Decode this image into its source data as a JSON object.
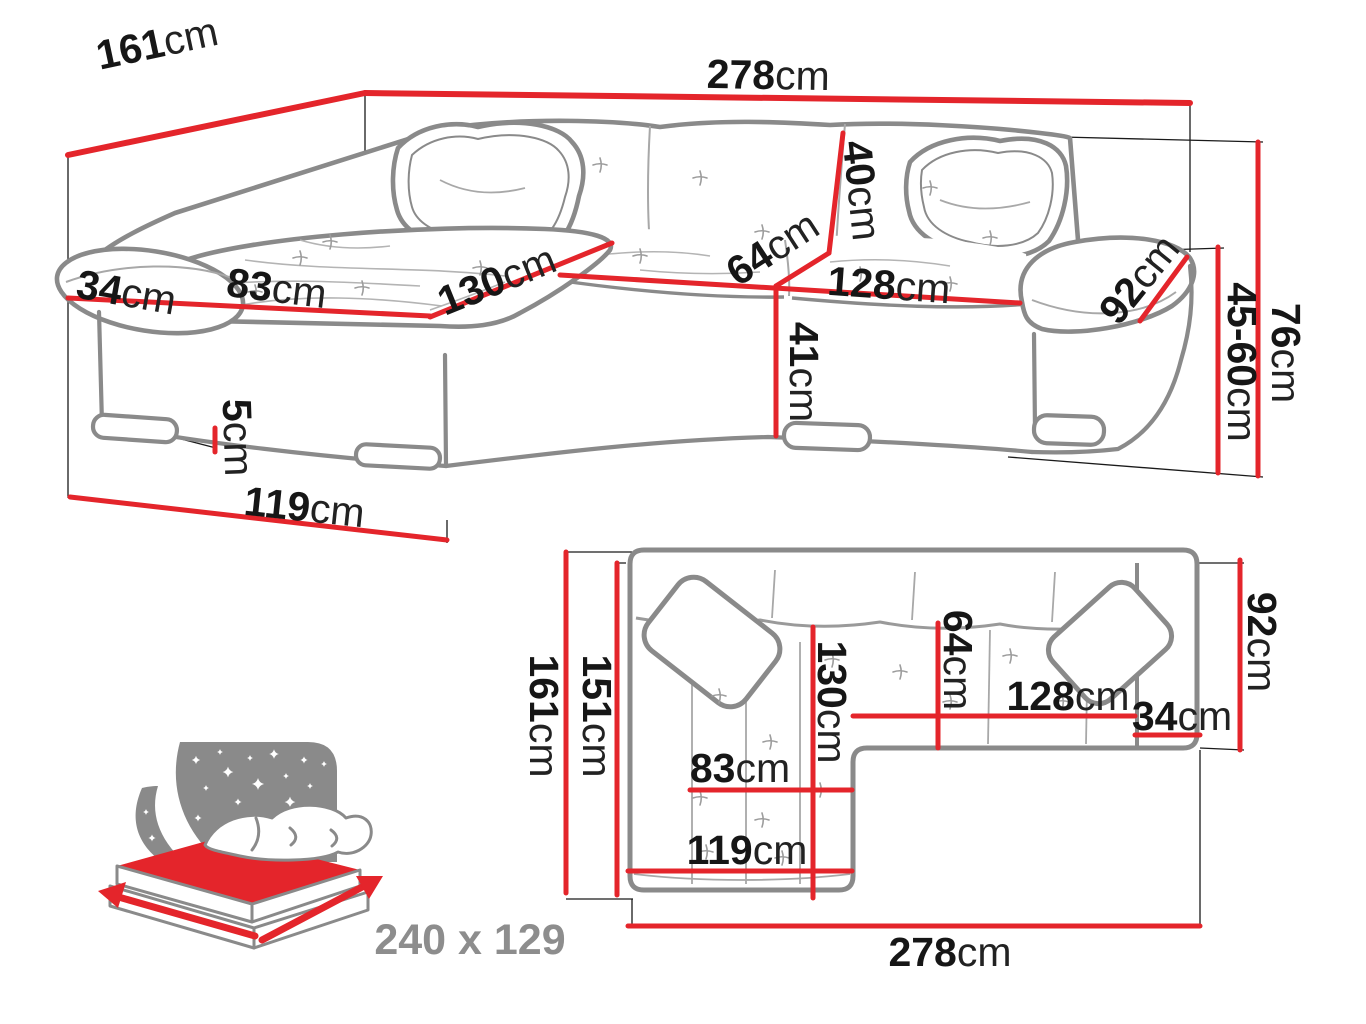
{
  "diagram_title": "Corner sofa bed dimension diagram",
  "colors": {
    "dimension_red": "#e4252b",
    "sofa_outline_gray": "#8a8a8a",
    "label_black": "#161616",
    "note_gray": "#8d8d8d",
    "background": "#ffffff"
  },
  "perspective_view": {
    "labels": [
      {
        "id": "depth-total",
        "value": "161",
        "unit": "cm"
      },
      {
        "id": "width-total",
        "value": "278",
        "unit": "cm"
      },
      {
        "id": "armrest-width",
        "value": "34",
        "unit": "cm"
      },
      {
        "id": "chaise-seat-width",
        "value": "83",
        "unit": "cm"
      },
      {
        "id": "chaise-depth",
        "value": "130",
        "unit": "cm"
      },
      {
        "id": "seat-depth",
        "value": "64",
        "unit": "cm"
      },
      {
        "id": "backrest-height",
        "value": "40",
        "unit": "cm"
      },
      {
        "id": "seat-width",
        "value": "128",
        "unit": "cm"
      },
      {
        "id": "armrest-depth",
        "value": "92",
        "unit": "cm"
      },
      {
        "id": "front-height",
        "value": "41",
        "unit": "cm"
      },
      {
        "id": "total-height",
        "value": "76",
        "ununit": "",
        "unit": "cm"
      },
      {
        "id": "seat-height-range",
        "value": "45-60",
        "unit": "cm"
      },
      {
        "id": "leg-height",
        "value": "5",
        "unit": "cm"
      },
      {
        "id": "chaise-length",
        "value": "119",
        "unit": "cm"
      }
    ]
  },
  "plan_view": {
    "labels": [
      {
        "id": "plan-depth-total",
        "value": "161",
        "unit": "cm"
      },
      {
        "id": "plan-depth-inner",
        "value": "151",
        "unit": "cm"
      },
      {
        "id": "plan-chaise-width",
        "value": "83",
        "unit": "cm"
      },
      {
        "id": "plan-chaise-length",
        "value": "119",
        "unit": "cm"
      },
      {
        "id": "plan-chaise-depth",
        "value": "130",
        "unit": "cm"
      },
      {
        "id": "plan-seat-depth",
        "value": "64",
        "unit": "cm"
      },
      {
        "id": "plan-seat-width",
        "value": "128",
        "unit": "cm"
      },
      {
        "id": "plan-armrest-width",
        "value": "34",
        "unit": "cm"
      },
      {
        "id": "plan-armrest-depth",
        "value": "92",
        "unit": "cm"
      },
      {
        "id": "plan-width-total",
        "value": "278",
        "unit": "cm"
      }
    ]
  },
  "sleeping_area": {
    "dimensions": "240 x 129"
  }
}
